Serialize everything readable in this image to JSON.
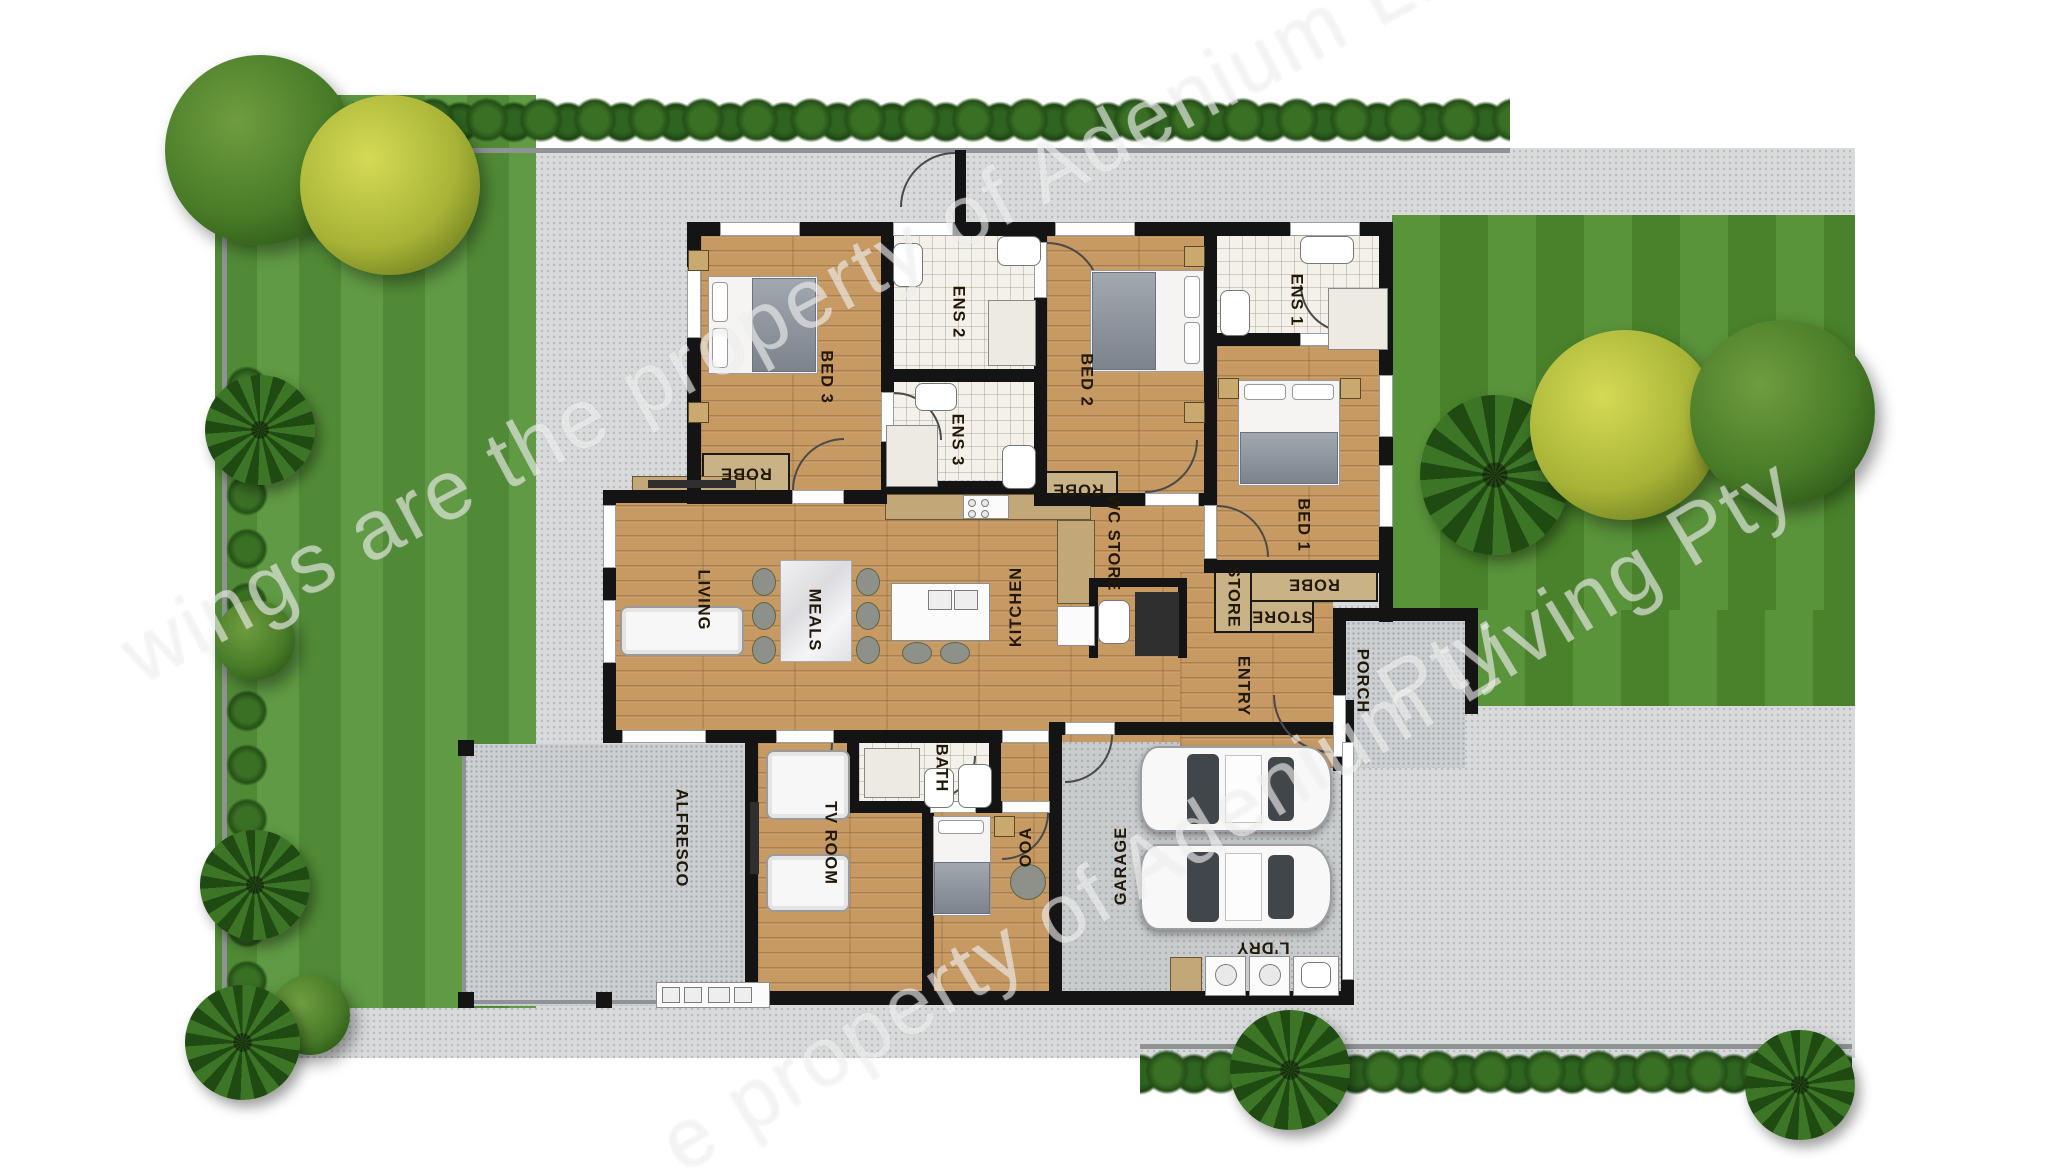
{
  "canvas": {
    "width": 2048,
    "height": 1175
  },
  "palette": {
    "paving": "#d8dadb",
    "grass": "#57953a",
    "lawn": "#4f8c2e",
    "wood_floor": "#c79a63",
    "tile": "#f3f1ea",
    "wall": "#141414",
    "hedge": "#2c5a1d",
    "tree_dark": "#497c28",
    "tree_yellow": "#a8b437",
    "label_text": "#221808",
    "watermark": "rgba(255,255,255,0.52)"
  },
  "rooms": [
    {
      "id": "bed-3",
      "label": "BED 3",
      "x": 826,
      "y": 377,
      "rot": 90
    },
    {
      "id": "ens-2",
      "label": "ENS 2",
      "x": 958,
      "y": 312,
      "rot": 90
    },
    {
      "id": "ens-3",
      "label": "ENS 3",
      "x": 957,
      "y": 440,
      "rot": 90
    },
    {
      "id": "bed-2",
      "label": "BED 2",
      "x": 1086,
      "y": 380,
      "rot": 90
    },
    {
      "id": "ens-1",
      "label": "ENS 1",
      "x": 1296,
      "y": 300,
      "rot": 90
    },
    {
      "id": "bed-1",
      "label": "BED 1",
      "x": 1303,
      "y": 525,
      "rot": 90
    },
    {
      "id": "living",
      "label": "LIVING",
      "x": 703,
      "y": 600,
      "rot": 90
    },
    {
      "id": "meals",
      "label": "MEALS",
      "x": 814,
      "y": 620,
      "rot": 90
    },
    {
      "id": "kitchen",
      "label": "KITCHEN",
      "x": 1016,
      "y": 607,
      "rot": -90
    },
    {
      "id": "wc-store",
      "label": "WC STORE",
      "x": 1113,
      "y": 543,
      "rot": 90
    },
    {
      "id": "entry",
      "label": "ENTRY",
      "x": 1243,
      "y": 686,
      "rot": 90
    },
    {
      "id": "porch",
      "label": "PORCH",
      "x": 1362,
      "y": 681,
      "rot": 90
    },
    {
      "id": "store-tall",
      "label": "STORE",
      "x": 1233,
      "y": 597,
      "rot": 90
    },
    {
      "id": "store-wide",
      "label": "STORE",
      "x": 1282,
      "y": 616,
      "rot": 180
    },
    {
      "id": "robe-bed3",
      "label": "ROBE",
      "x": 746,
      "y": 473,
      "rot": 180
    },
    {
      "id": "robe-bed2",
      "label": "ROBE",
      "x": 1078,
      "y": 489,
      "rot": 180
    },
    {
      "id": "robe-bed1",
      "label": "ROBE",
      "x": 1314,
      "y": 584,
      "rot": 180
    },
    {
      "id": "bath",
      "label": "BATH",
      "x": 941,
      "y": 768,
      "rot": 90
    },
    {
      "id": "tv-room",
      "label": "TV ROOM",
      "x": 830,
      "y": 843,
      "rot": 90
    },
    {
      "id": "alfresco",
      "label": "ALFRESCO",
      "x": 681,
      "y": 838,
      "rot": 90
    },
    {
      "id": "ooa",
      "label": "OOA",
      "x": 1026,
      "y": 847,
      "rot": -90
    },
    {
      "id": "garage",
      "label": "GARAGE",
      "x": 1121,
      "y": 866,
      "rot": -90
    },
    {
      "id": "ldry",
      "label": "L'DRY",
      "x": 1263,
      "y": 947,
      "rot": 180
    }
  ],
  "watermarks": [
    {
      "id": "wm-top",
      "text": "wings are the property of Adenium Liv",
      "x": 128,
      "y": 660,
      "rot": -28,
      "size": 84
    },
    {
      "id": "wm-bottom",
      "text": "e property of Adenium Living Pty",
      "x": 668,
      "y": 1150,
      "rot": -31,
      "size": 84
    },
    {
      "id": "wm-fragment",
      "text": "Pty",
      "x": 1385,
      "y": 700,
      "rot": -30,
      "size": 84
    }
  ]
}
